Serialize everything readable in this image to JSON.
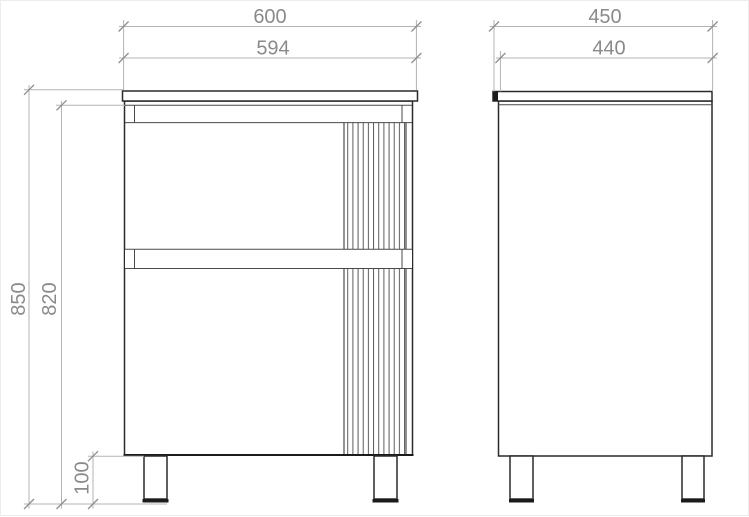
{
  "drawing": {
    "type": "technical-dimension-drawing",
    "subject": "two-drawer vanity cabinet, front and side orthographic views",
    "colors": {
      "object_line": "#1b1b1b",
      "dimension_line": "#b3b3b3",
      "dimension_text": "#8a8a8a",
      "background": "#ffffff"
    }
  },
  "dimensions": {
    "front": [
      {
        "name": "counter-width",
        "value": "600"
      },
      {
        "name": "body-width",
        "value": "594"
      },
      {
        "name": "overall-height",
        "value": "850"
      },
      {
        "name": "body-height",
        "value": "820"
      },
      {
        "name": "leg-height",
        "value": "100"
      }
    ],
    "side": [
      {
        "name": "counter-depth",
        "value": "450"
      },
      {
        "name": "body-depth",
        "value": "440"
      }
    ]
  }
}
